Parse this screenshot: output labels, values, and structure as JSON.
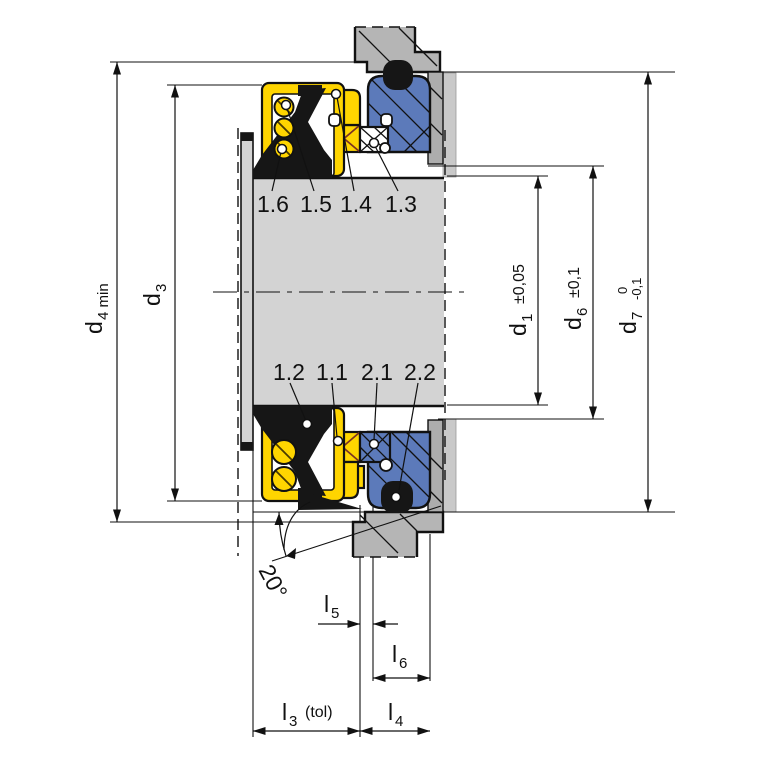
{
  "drawing_type": "mechanical-seal-cross-section",
  "parts": {
    "p16": "1.6",
    "p15": "1.5",
    "p14": "1.4",
    "p13": "1.3",
    "p12": "1.2",
    "p11": "1.1",
    "p21": "2.1",
    "p22": "2.2"
  },
  "dims": {
    "d4": {
      "base": "d",
      "sub": "4 min"
    },
    "d3": {
      "base": "d",
      "sub": "3"
    },
    "d1": {
      "base": "d",
      "sub": "1",
      "tol": "±0,05"
    },
    "d6": {
      "base": "d",
      "sub": "6",
      "tol": "±0,1"
    },
    "d7": {
      "base": "d",
      "sub": "7",
      "tol_upper": "0",
      "tol_lower": "-0,1"
    },
    "l3": {
      "base": "l",
      "sub": "3",
      "tol": "(tol)"
    },
    "l4": {
      "base": "l",
      "sub": "4"
    },
    "l5": {
      "base": "l",
      "sub": "5"
    },
    "l6": {
      "base": "l",
      "sub": "6"
    },
    "angle": "20°"
  },
  "colors": {
    "rotating_unit_yellow": "#FFD500",
    "stationary_seat_blue": "#5C7ABA",
    "elastomer_black": "#161616",
    "shaft_gray": "#D3D3D3",
    "housing_gray": "#B5B5B5",
    "housing_band_gray": "#ADADAD",
    "break_strip_gray": "#C9C9C9",
    "hatch_red": "#7B3222"
  }
}
